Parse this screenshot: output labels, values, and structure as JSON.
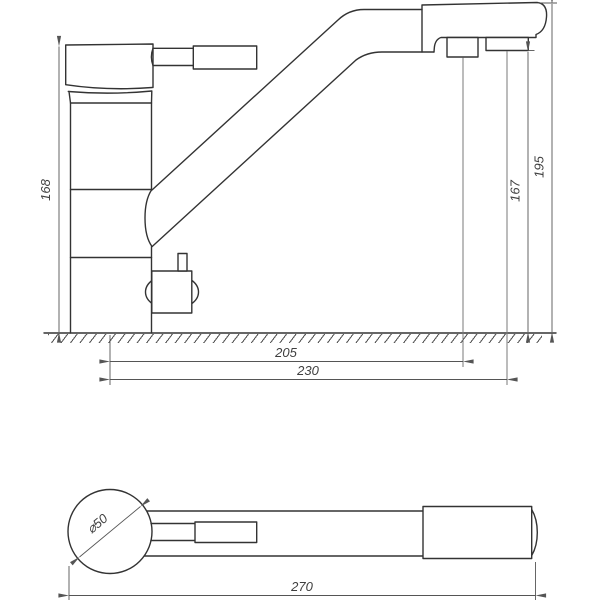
{
  "colors": {
    "background": "#ffffff",
    "line": "#333333",
    "dimension": "#555555"
  },
  "side_view": {
    "dim_body_height": "168",
    "dim_spout_outlet_height": "167",
    "dim_total_height": "195",
    "dim_aerator_reach": "205",
    "dim_outlet_reach": "230"
  },
  "top_view": {
    "dim_base_diameter": "⌀50",
    "dim_total_length": "270"
  }
}
